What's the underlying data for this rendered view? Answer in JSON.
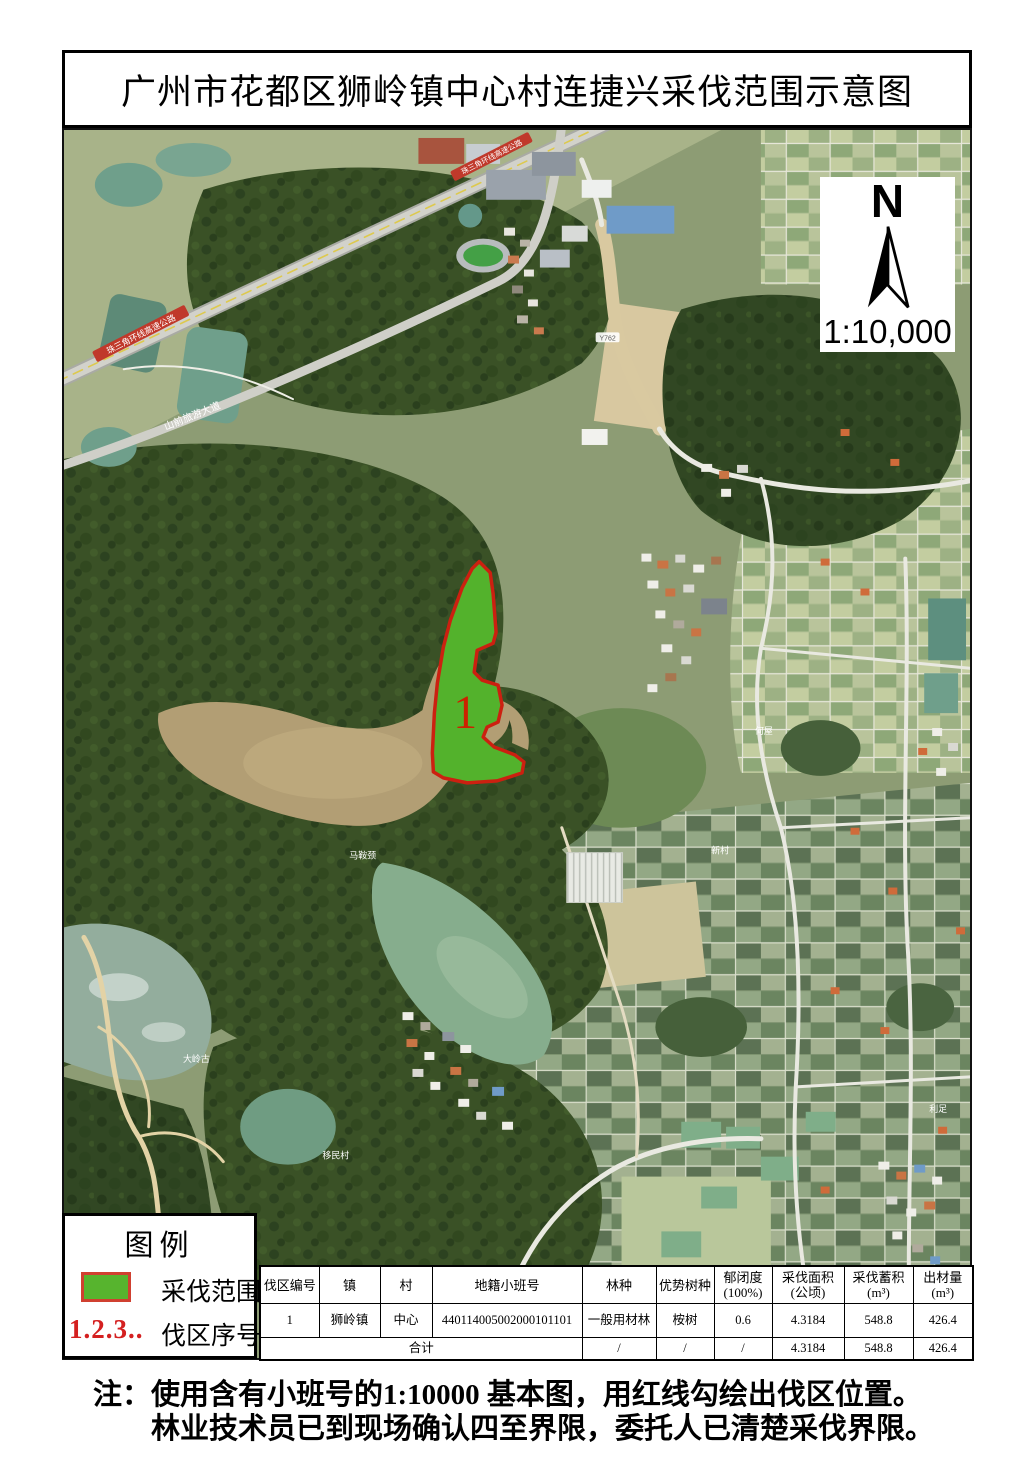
{
  "title": "广州市花都区狮岭镇中心村连捷兴采伐范围示意图",
  "compass": {
    "north": "N",
    "scale": "1:10,000"
  },
  "map": {
    "cut_area_label": "1",
    "labels": {
      "expressway": "珠三角环线高速公路",
      "avenue": "山前旅游大道",
      "road_code": "Y762",
      "maanjing": "马鞍颈",
      "dalinggu": "大岭古",
      "yimincun": "移民村",
      "hewu": "何屋",
      "xincun": "新村",
      "lizu": "利足"
    }
  },
  "legend": {
    "title": "图例",
    "area_label": "采伐范围",
    "seq_symbol": "1.2.3..",
    "seq_label": "伐区序号"
  },
  "table": {
    "headers": [
      {
        "l1": "伐区编号",
        "l2": ""
      },
      {
        "l1": "镇",
        "l2": ""
      },
      {
        "l1": "村",
        "l2": ""
      },
      {
        "l1": "地籍小班号",
        "l2": ""
      },
      {
        "l1": "林种",
        "l2": ""
      },
      {
        "l1": "优势树种",
        "l2": ""
      },
      {
        "l1": "郁闭度",
        "l2": "(100%)"
      },
      {
        "l1": "采伐面积",
        "l2": "(公顷)"
      },
      {
        "l1": "采伐蓄积",
        "l2": "(m³)"
      },
      {
        "l1": "出材量",
        "l2": "(m³)"
      }
    ],
    "row": {
      "no": "1",
      "town": "狮岭镇",
      "village": "中心",
      "parcel": "440114005002000101101",
      "forest_type": "一般用材林",
      "species": "桉树",
      "canopy": "0.6",
      "area": "4.3184",
      "volume": "548.8",
      "output": "426.4"
    },
    "total": {
      "label": "合计",
      "forest_type": "/",
      "species": "/",
      "canopy": "/",
      "area": "4.3184",
      "volume": "548.8",
      "output": "426.4"
    }
  },
  "note": {
    "line1": "注：使用含有小班号的1:10000 基本图，用红线勾绘出伐区位置。",
    "line2": "林业技术员已到现场确认四至界限，委托人已清楚采伐界限。"
  },
  "colors": {
    "cut_fill": "#53b22c",
    "cut_stroke": "#cc2010",
    "legend_red": "#d42020"
  }
}
